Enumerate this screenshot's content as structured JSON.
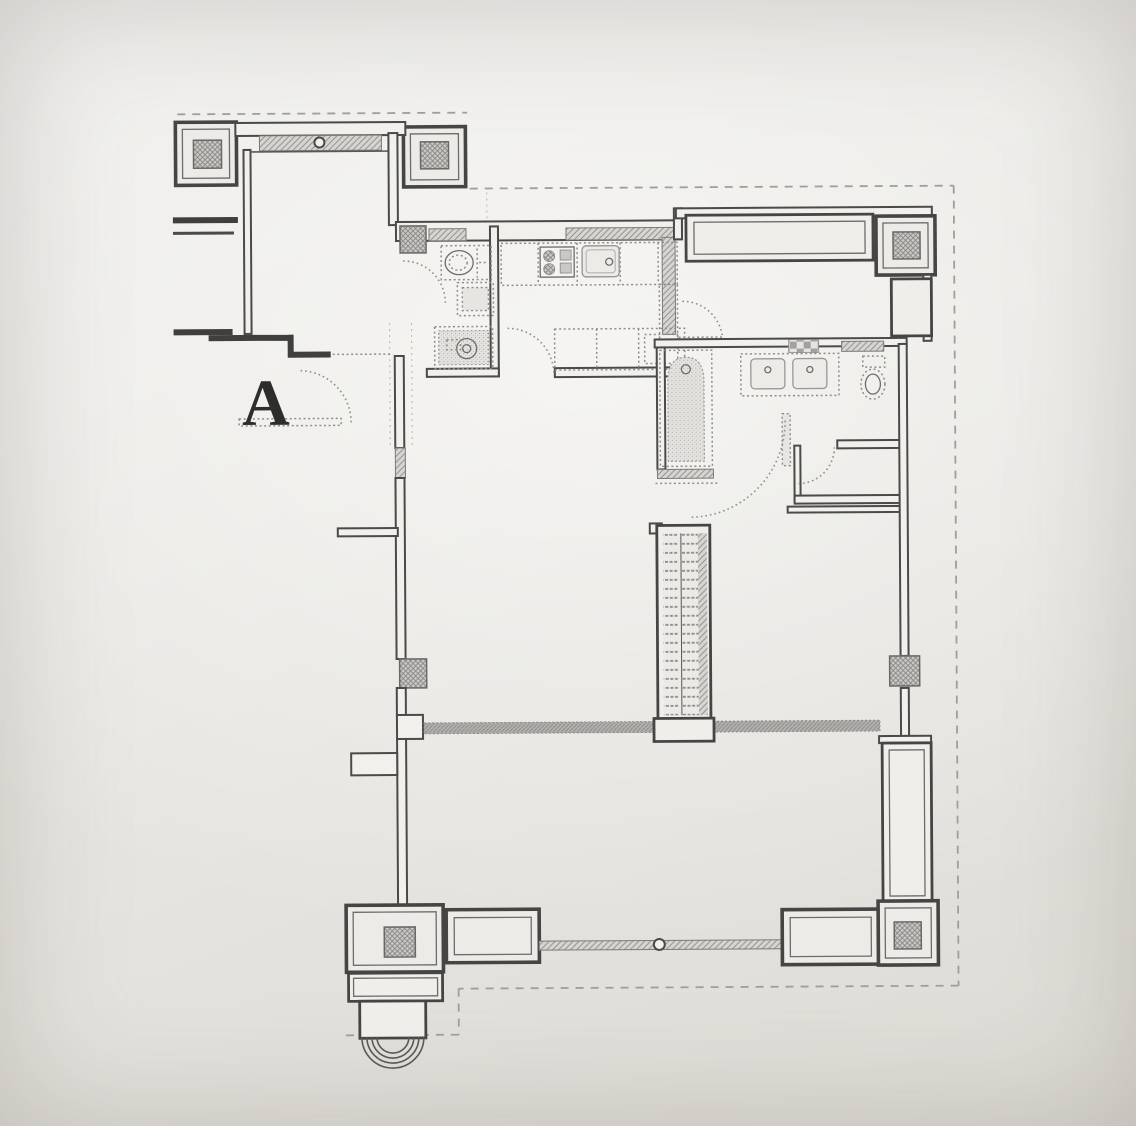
{
  "plan": {
    "unit_label": "A",
    "colors": {
      "paper": "#e9e7e3",
      "ink": "#454543",
      "hatch_fill": "#d6d4d0",
      "core_fill": "#cbc9c6",
      "band_fill": "#b5b3b0",
      "label_ink": "#2d2d2b"
    },
    "fixtures": [
      "structural-column",
      "window",
      "balcony-railing",
      "wardrobe",
      "toilet",
      "shower-tray",
      "washing-machine",
      "kitchen-counter",
      "stove-4-burner",
      "kitchen-sink",
      "bathtub",
      "vanity-sink",
      "stair-duct-shaft",
      "door-swing",
      "arched-niche",
      "duct-box"
    ]
  }
}
